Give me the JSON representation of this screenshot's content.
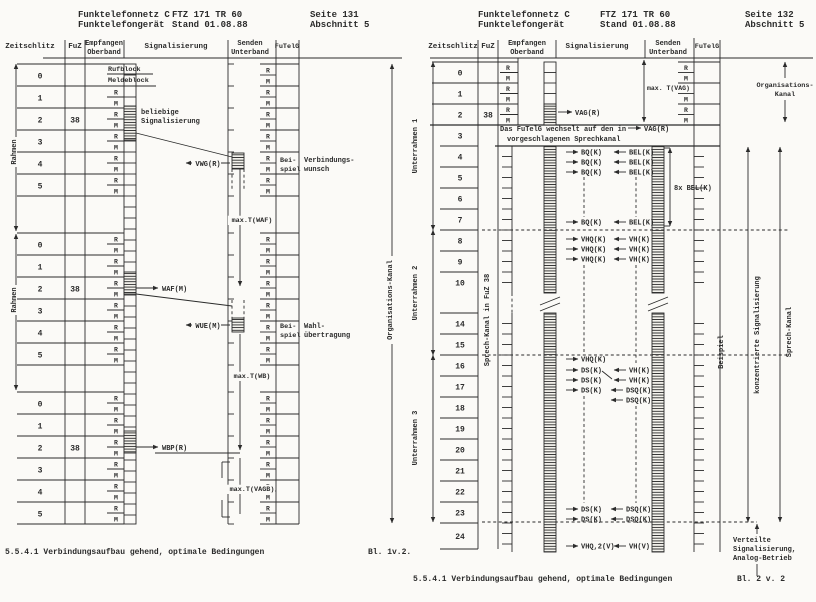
{
  "ink": "#2b2b2b",
  "paper": "#fbfaf7",
  "page1": {
    "header": {
      "product1": "Funktelefonnetz C",
      "product2": "Funktelefongerät",
      "doc1": "FTZ 171 TR 60",
      "doc2": "Stand 01.08.88",
      "page1": "Seite 131",
      "page2": "Abschnitt 5"
    },
    "columns": {
      "zeitschlitz": "Zeitschlitz",
      "fuz": "FuZ",
      "empfangen_1": "Empfangen",
      "empfangen_2": "Oberband",
      "signalisierung": "Signalisierung",
      "senden_1": "Senden",
      "senden_2": "Unterband",
      "futelg": "FuTelG"
    },
    "rm": {
      "r": "R",
      "m": "M"
    },
    "frame_label": "Rahmen",
    "slots": [
      "0",
      "1",
      "2",
      "3",
      "4",
      "5"
    ],
    "fuz_value": "38",
    "row0": {
      "r": "Rufblock",
      "m": "Meldeblock"
    },
    "ann": {
      "beliebige_1": "beliebige",
      "beliebige_2": "Signalisierung",
      "vwg": "VWG(R)",
      "waf": "WAF(M)",
      "wue": "WUE(M)",
      "wbp": "WBP(R)",
      "beispiel_1": "Bei-",
      "beispiel_2": "spiel",
      "verbindung_1": "Verbindungs-",
      "verbindung_2": "wunsch",
      "wahl_1": "Wahl-",
      "wahl_2": "übertragung",
      "t_waf": "max.T(WAF)",
      "t_wb": "max.T(WB)",
      "t_vagb": "max.T(VAGB)"
    },
    "side_label": "Organisations-Kanal",
    "caption": "5.5.4.1 Verbindungsaufbau gehend, optimale Bedingungen",
    "sheet": "Bl. 1v.2."
  },
  "page2": {
    "header": {
      "product1": "Funktelefonnetz C",
      "product2": "Funktelefongerät",
      "doc1": "FTZ 171 TR 60",
      "doc2": "Stand 01.08.88",
      "page1": "Seite 132",
      "page2": "Abschnitt 5"
    },
    "columns": {
      "zeitschlitz": "Zeitschlitz",
      "fuz": "FuZ",
      "empfangen_1": "Empfangen",
      "empfangen_2": "Oberband",
      "signalisierung": "Signalisierung",
      "senden_1": "Senden",
      "senden_2": "Unterband",
      "futelg": "FuTelG"
    },
    "rm": {
      "r": "R",
      "m": "M"
    },
    "fuz_value": "38",
    "subframes": [
      "Unterrahmen 1",
      "Unterrahmen 2",
      "Unterrahmen 3"
    ],
    "slots": [
      "0",
      "1",
      "2",
      "3",
      "4",
      "5",
      "6",
      "7",
      "8",
      "9",
      "10",
      "14",
      "15",
      "16",
      "17",
      "18",
      "19",
      "20",
      "21",
      "22",
      "23",
      "24"
    ],
    "note_1": "Das FuTelG wechselt auf den in",
    "note_2": "vorgeschlagenen Sprechkanal",
    "sig": {
      "vag": "VAG(R)",
      "bq": "BQ(K)",
      "bel": "BEL(K)",
      "bel8": "8x BEL(K)",
      "vhq": "VHQ(K)",
      "vh": "VH(K)",
      "ds": "DS(K)",
      "dsq": "DSQ(K)",
      "vhq2": "VHQ,2(V)",
      "vhv": "VH(V)"
    },
    "t_vag": "max. T(VAG)",
    "org_1": "Organisations-",
    "org_2": "Kanal",
    "sprechkanal_fuz": "Sprech-Kanal in FuZ 38",
    "beispiel": "Beispiel",
    "konzentriert": "konzentrierte Signalisierung",
    "sprechkanal": "Sprech-Kanal",
    "verteilte_1": "Verteilte",
    "verteilte_2": "Signalisierung,",
    "verteilte_3": "Analog-Betrieb",
    "caption": "5.5.4.1 Verbindungsaufbau gehend, optimale Bedingungen",
    "sheet": "Bl. 2 v. 2"
  }
}
